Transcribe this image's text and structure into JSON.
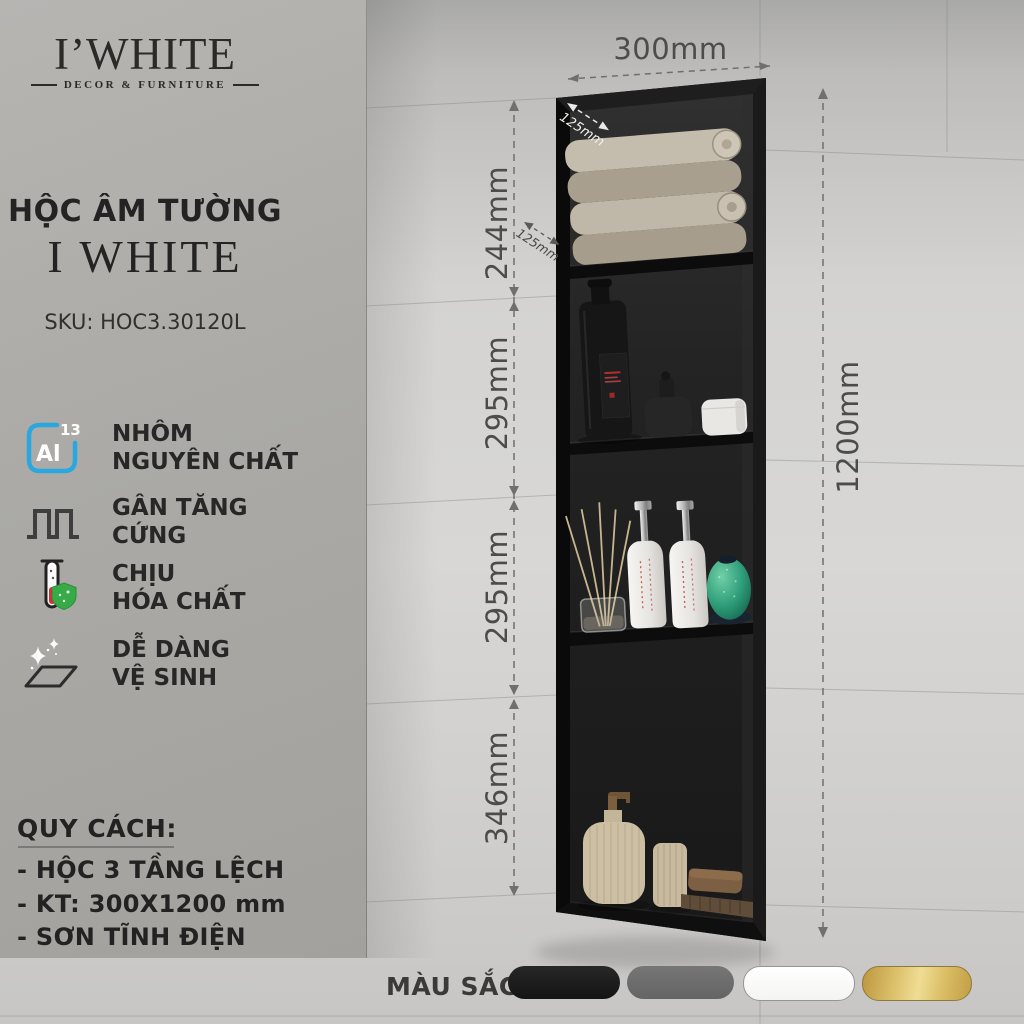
{
  "brand": {
    "name": "I’WHITE",
    "tagline": "DECOR & FURNITURE"
  },
  "product": {
    "title": "HỘC ÂM TƯỜNG",
    "subtitle": "I WHITE",
    "sku": "SKU: HOC3.30120L"
  },
  "features": {
    "al_symbol": "Al",
    "al_number": "13",
    "items": [
      {
        "icon": "aluminum-al13-icon",
        "lines": [
          "NHÔM",
          "NGUYÊN CHẤT"
        ]
      },
      {
        "icon": "stiffening-ribs-icon",
        "lines": [
          "GÂN TĂNG",
          "CỨNG"
        ]
      },
      {
        "icon": "chemical-resistant-icon",
        "lines": [
          "CHỊU",
          "HÓA CHẤT"
        ]
      },
      {
        "icon": "easy-clean-icon",
        "lines": [
          "DỄ DÀNG",
          "VỆ SINH"
        ]
      }
    ]
  },
  "specs": {
    "heading": "QUY CÁCH:",
    "items": [
      "- HỘC 3 TẦNG LỆCH",
      "- KT: 300X1200 mm",
      "- SƠN TĨNH ĐIỆN"
    ]
  },
  "dimensions": {
    "width": "300mm",
    "height": "1200mm",
    "depth_top": "125mm",
    "depth_shelf": "125mm",
    "segments": [
      "244mm",
      "295mm",
      "295mm",
      "346mm"
    ]
  },
  "colors_row": {
    "label": "MÀU SẮC",
    "swatches": [
      {
        "name": "black",
        "hex": "#1e1e1e"
      },
      {
        "name": "gray",
        "hex": "#6e6e6e"
      },
      {
        "name": "white",
        "hex": "#ffffff"
      },
      {
        "name": "gold",
        "hex": "#d7b85e"
      }
    ]
  },
  "palette": {
    "accent_blue": "#29a8e0",
    "shield_green": "#37ab47",
    "liquid_red": "#e8262d",
    "frame_black": "#141414"
  }
}
